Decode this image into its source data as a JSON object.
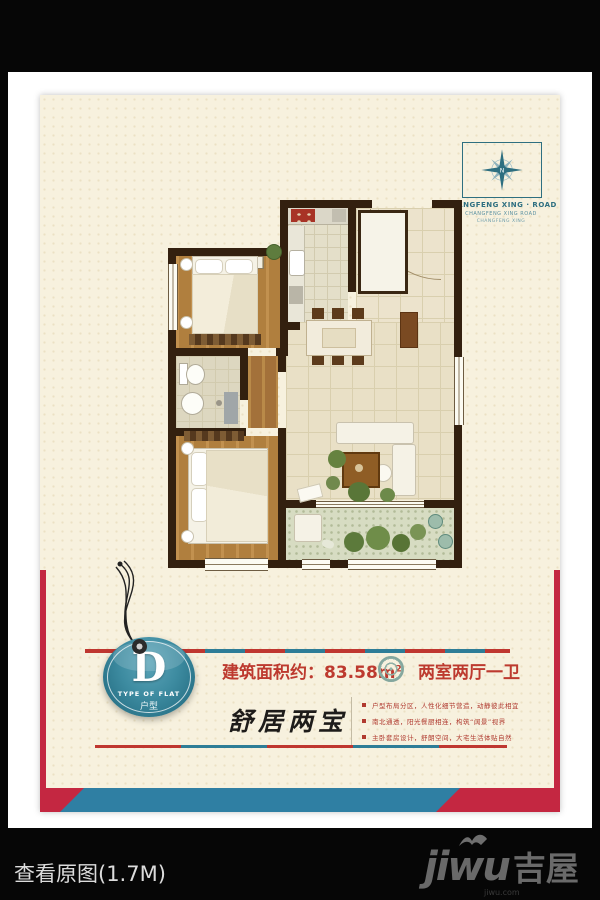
{
  "frame": {
    "view_original_label": "查看原图(1.7M)"
  },
  "watermark": {
    "latin": "jiwu",
    "cjk": "吉屋",
    "site": "jiwu.com"
  },
  "logo": {
    "compass_letter": "N",
    "title": "CHANGFENG XING · ROAD",
    "sub1": "CHANGFENG XING ROAD",
    "sub2": "CHANGFENG XING"
  },
  "badge": {
    "letter": "D",
    "subtitle": "TYPE OF FLAT",
    "cjk": "户型"
  },
  "infobar": {
    "area_label": "建筑面积约：",
    "area_value": "83.58m",
    "area_sup": "2",
    "layout_label": "两室两厅一卫"
  },
  "slogan": "舒居两宝",
  "bullets": [
    "户型布局分区，人性化细节营造，动静彼此相宜",
    "南北通透，阳光餐厨相连，构筑“阔景”视界",
    "主卧套房设计，舒朗空间，大宅生活体贴自然"
  ],
  "colors": {
    "accent_red": "#c42741",
    "accent_blue": "#2f7fa3",
    "badge_teal": "#2f7f95",
    "poster_bg": "#f7f1de",
    "text_red": "#bd3a2f",
    "wall_brown": "#33200f"
  }
}
